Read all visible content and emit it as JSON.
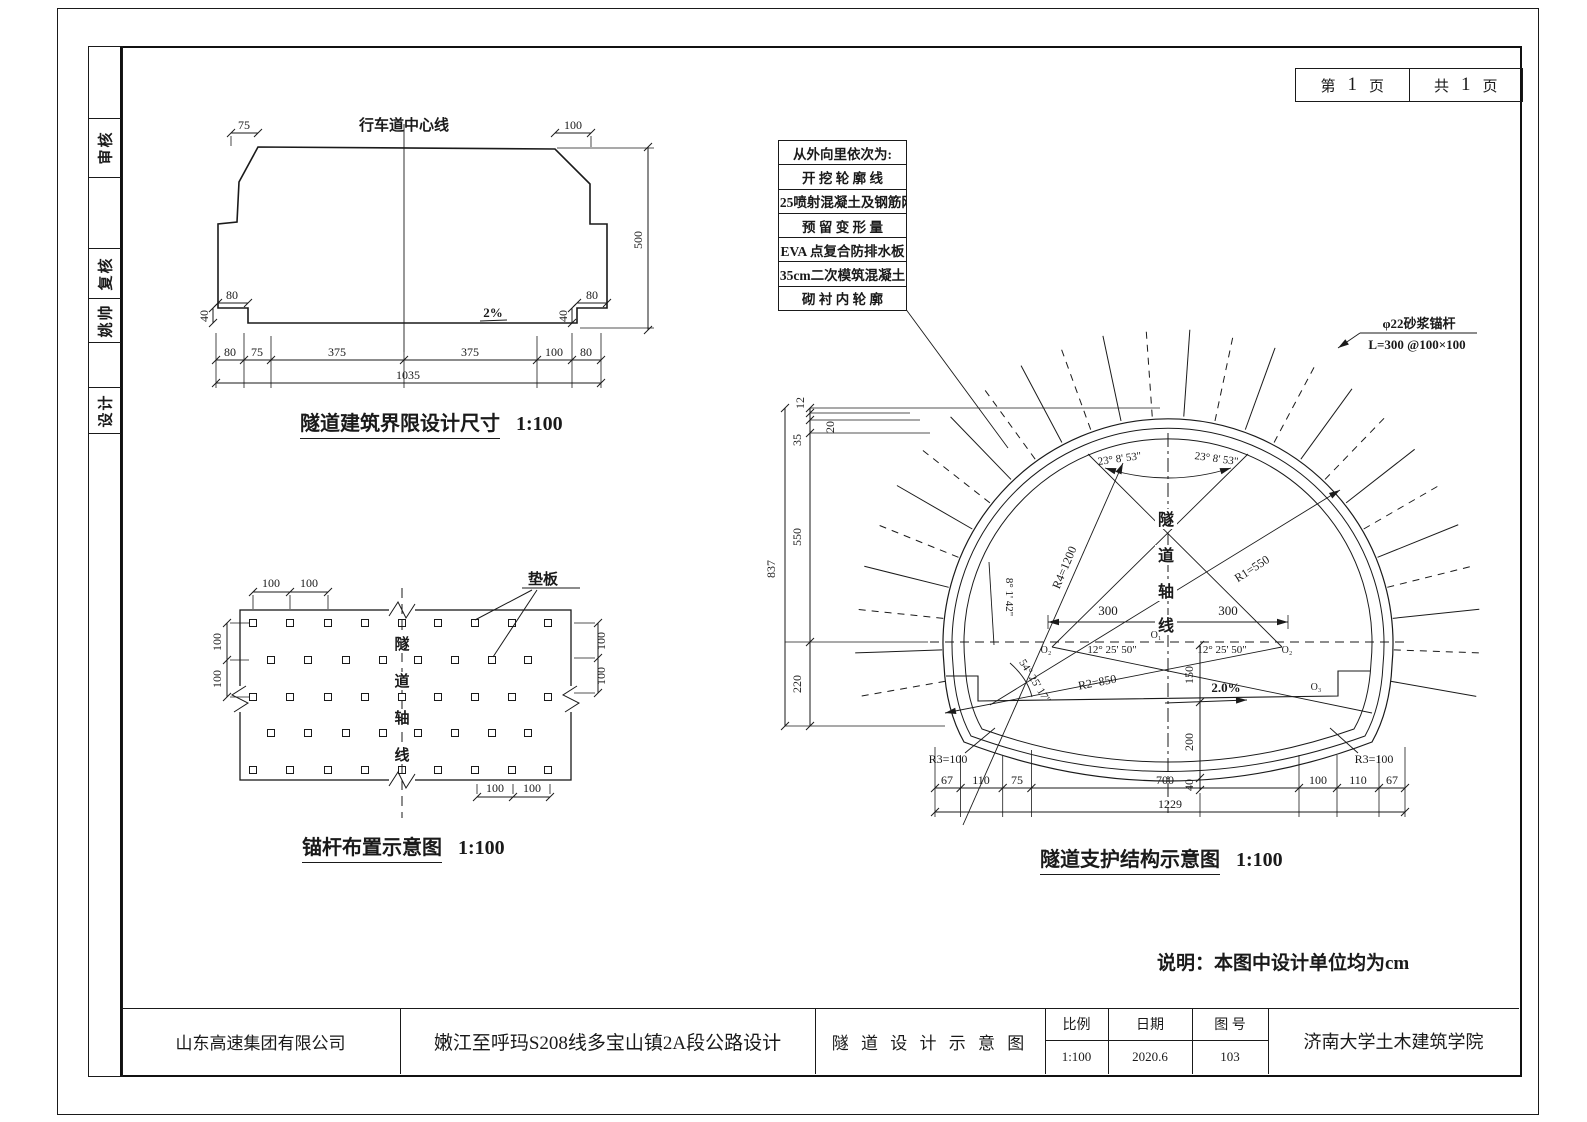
{
  "sidebar": {
    "items": [
      {
        "label": "审核"
      },
      {
        "label": "复核"
      },
      {
        "label": "姚帅"
      },
      {
        "label": "设计"
      }
    ]
  },
  "page_box": {
    "cur_label": "第",
    "cur_num": "1",
    "cur_unit": "页",
    "tot_label": "共",
    "tot_num": "1",
    "tot_unit": "页"
  },
  "clearance": {
    "title": "隧道建筑界限设计尺寸",
    "scale": "1:100",
    "center_line": "行车道中心线",
    "slope": "2%",
    "dims": {
      "top_left": "75",
      "top_right": "100",
      "height": "500",
      "curb_w_left": "80",
      "curb_h_left": "40",
      "curb_w_right": "80",
      "curb_h_right": "40",
      "bottom": [
        "80",
        "75",
        "375",
        "375",
        "100",
        "80"
      ],
      "total": "1035"
    }
  },
  "bolts": {
    "title": "锚杆布置示意图",
    "scale": "1:100",
    "pad_label": "垫板",
    "axis": [
      "隧",
      "道",
      "轴",
      "线"
    ],
    "dims": {
      "top": [
        "100",
        "100"
      ],
      "left": [
        "100",
        "100"
      ],
      "right": [
        "100",
        "100"
      ],
      "bottom": [
        "100",
        "100"
      ]
    }
  },
  "support": {
    "title": "隧道支护结构示意图",
    "scale": "1:100",
    "layers": {
      "header": "从外向里依次为:",
      "rows": [
        "开 挖 轮 廓 线",
        "C25喷射混凝土及钢筋网",
        "预 留 变 形 量",
        "EVA 点复合防排水板",
        "35cm二次模筑混凝土",
        "砌 衬 内 轮 廓"
      ]
    },
    "bolt_note": {
      "line1": "φ22砂浆锚杆",
      "line2": "L=300 @100×100"
    },
    "axis": [
      "隧",
      "道",
      "轴",
      "线"
    ],
    "angles": {
      "crown_left": "23° 8' 53\"",
      "crown_right": "23° 8' 53\"",
      "spring_left": "12° 25' 50\"",
      "spring_right": "12° 25' 50\"",
      "side": "8° 1' 42\"",
      "invert": "54° 25' 17\""
    },
    "radii": {
      "r1": "R1=550",
      "r2": "R2=850",
      "r3l": "R3=100",
      "r3r": "R3=100",
      "r4": "R4=1200"
    },
    "points": {
      "o1": "O₁",
      "o2l": "O₂",
      "o2r": "O₂",
      "o3": "O₃"
    },
    "slope": "2.0%",
    "dims": {
      "span_left": "300",
      "span_right": "300",
      "v150": "150",
      "v200": "200",
      "v40": "40",
      "left": [
        "12",
        "20",
        "35",
        "550",
        "220"
      ],
      "left_total": "837",
      "bottom": [
        "67",
        "110",
        "75",
        "700",
        "100",
        "110",
        "67"
      ],
      "bottom_total": "1229"
    }
  },
  "note": "说明：本图中设计单位均为cm",
  "title_block": {
    "company": "山东高速集团有限公司",
    "project": "嫩江至呼玛S208线多宝山镇2A段公路设计",
    "drawing": "隧 道 设 计 示 意 图",
    "scale_label": "比例",
    "scale_value": "1:100",
    "date_label": "日期",
    "date_value": "2020.6",
    "no_label": "图 号",
    "no_value": "103",
    "institute": "济南大学土木建筑学院"
  }
}
